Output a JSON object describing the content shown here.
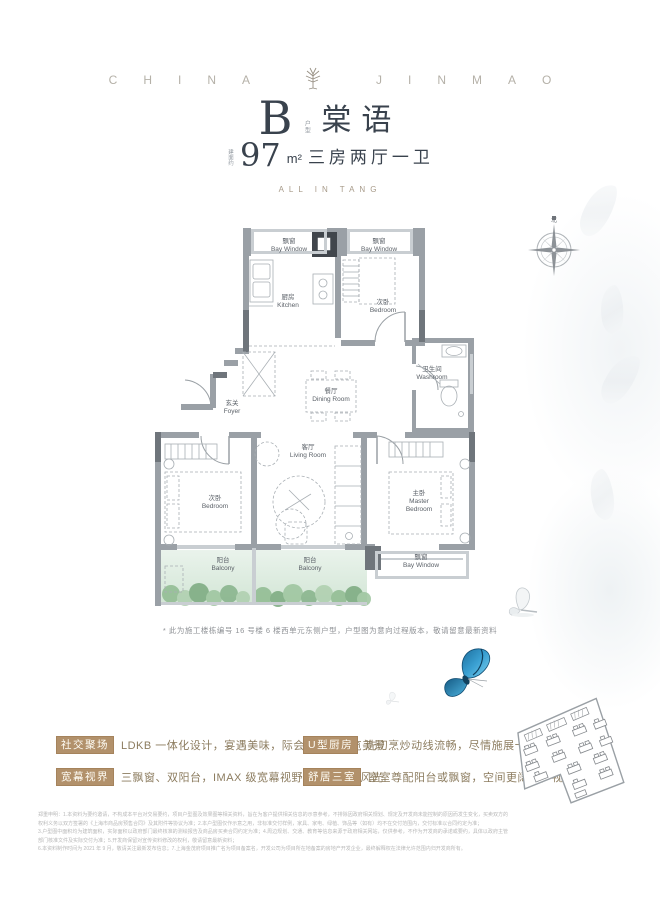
{
  "colors": {
    "title_text": "#39424d",
    "brand_text": "#b5b1a8",
    "accent_tan": "#b2916b",
    "feature_text": "#8c7c5f",
    "wall_gray": "#9aa0a6",
    "balcony_green": "#dcebdd",
    "butterfly_blue": "#2f8fc4"
  },
  "brand": {
    "left": "CHINA",
    "right": "JINMAO"
  },
  "title": {
    "unit_letter": "B",
    "unit_note": "户型",
    "unit_name": "棠语",
    "area_prefix": "建面约",
    "area_number": "97",
    "area_unit": "m²",
    "layout_text": "三房两厅一卫",
    "subtitle_en": "ALL IN TANG"
  },
  "floor_plan": {
    "compass_north": "北",
    "rooms": [
      {
        "zh": "飘窗",
        "en": "Bay Window"
      },
      {
        "zh": "厨房",
        "en": "Kitchen"
      },
      {
        "zh": "飘窗",
        "en": "Bay Window"
      },
      {
        "zh": "次卧",
        "en": "Bedroom"
      },
      {
        "zh": "卫生间",
        "en": "Washroom"
      },
      {
        "zh": "玄关",
        "en": "Foyer"
      },
      {
        "zh": "餐厅",
        "en": "Dining Room"
      },
      {
        "zh": "客厅",
        "en": "Living Room"
      },
      {
        "zh": "次卧",
        "en": "Bedroom"
      },
      {
        "zh": "主卧",
        "en": "Master Bedroom"
      },
      {
        "zh": "阳台",
        "en": "Balcony"
      },
      {
        "zh": "阳台",
        "en": "Balcony"
      },
      {
        "zh": "飘窗",
        "en": "Bay Window"
      }
    ],
    "note": "* 此为施工楼栋编号 16 号楼 6 楼西单元东侧户型，户型图为意向过程版本，敬请留意最新资料"
  },
  "features": [
    {
      "badge": "社交聚场",
      "text": "LDKB 一体化设计，宴遇美味，际会美好，尽览美景"
    },
    {
      "badge": "U型厨房",
      "text": "洗切烹炒动线流畅，尽情施展十八般厨艺"
    },
    {
      "badge": "宽幕视界",
      "text": "三飘窗、双阳台，IMAX 级宽幕视野，俯赏四时风光"
    },
    {
      "badge": "舒居三室",
      "text": "室室尊配阳台或飘窗，空间更阔绰，视野更优越"
    }
  ],
  "disclaimer": {
    "lines": [
      "郑重申明：1.本资料为要约邀请，不构成本平台对交易要约，项目户型图及效果图等相关资料，旨在为客户提供相关信息的示意参考，不排除因政府相关规划、规定及开发商未能控制的原因而发生变化，买卖双方的权利义务以双方签署的《上海市商品房预售合同》及其附件等协议为准；2.本户型图仅作示意之用，非标准交付样例，家具、家电、绿植、饰品等（如有）均不在交付范围内，交付标准以合同约定为准；",
      "3.户型图中面积均为建筑面积，实际面积以政府部门最终核准的测绘报告及商品房买卖合同约定为准；4.周边规划、交通、教育等信息来源于政府相关网站，仅供参考，不作为开发商的承诺或要约，具体以政府主管部门核准文件及实际交付为准；5.开发商保留对宣传资料修改的权利，敬请留意最新资料；",
      "6.本资料制作时间为 2021 年 9 月，敬请关注最新发布信息；7.上海金茂府项目推广名为项目备案名，开发公司为项目所在地备案的房地产开发企业，最终解释权在法律允许范围内归开发商所有。"
    ]
  }
}
